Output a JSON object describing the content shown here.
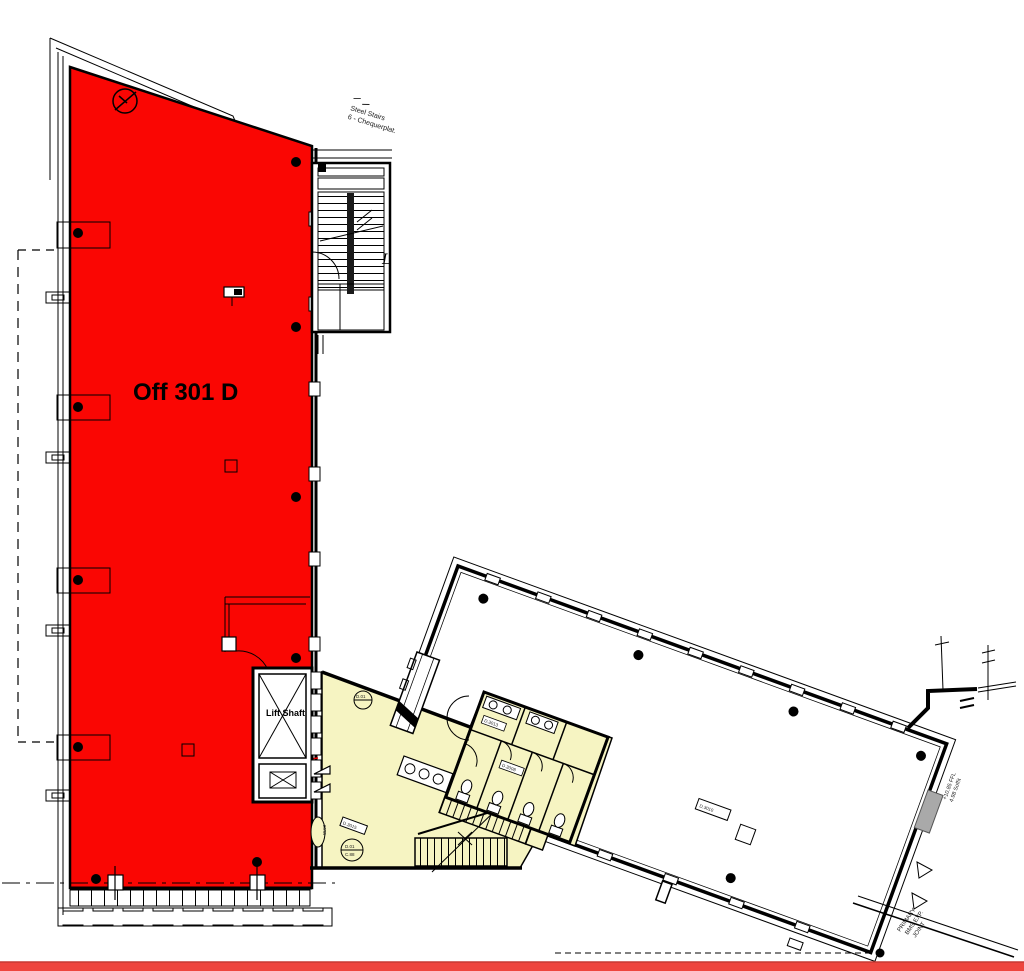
{
  "annotations": {
    "room_label": "Off 301 D",
    "lift_label": "Lift Shaft",
    "stairs_note": [
      "Steel Stairs",
      "6 - Chequerplat."
    ],
    "letter_mark": "L",
    "level_note": [
      "+10.85 FFL",
      "4.98 Soffit"
    ],
    "joint_note": [
      "PRIMARY",
      "BMS EXP.",
      "JOINT"
    ],
    "micro_labels": {
      "lobby_door_circle": "D.01",
      "lobby_datum_line1": "D.01",
      "lobby_datum_line2": "C.88",
      "lobby_oval": "W.03",
      "lobby_tag": "D.3015",
      "toilet_tag_a": "D.3013",
      "toilet_tag_b": "D.3008",
      "hall_tag": "D.3010"
    }
  },
  "colors": {
    "red_zone": "#fa0603",
    "yellow_zone": "#f6f4c2",
    "red_arc": "#e60000",
    "grey_block": "#a9a9a9",
    "bottom_bar": "#ee453e",
    "bottom_bar_edge": "#c63a33"
  }
}
